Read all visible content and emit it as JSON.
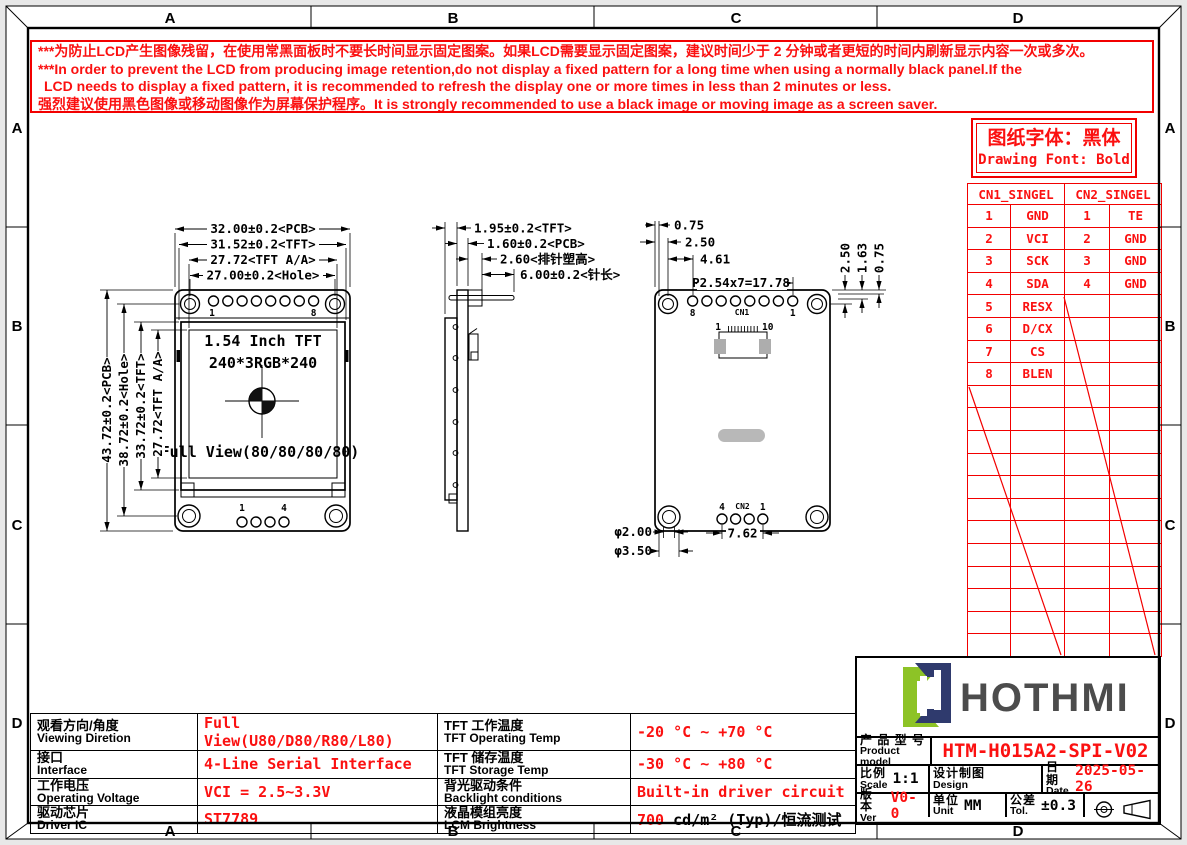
{
  "page": {
    "zones_h": [
      "A",
      "B",
      "C",
      "D"
    ],
    "zones_v": [
      "A",
      "B",
      "C",
      "D"
    ]
  },
  "colors": {
    "line_red": "#f20000",
    "text_red": "#fb1010",
    "logo_green": "#8dc326",
    "logo_navy": "#2f3a6d",
    "brand_gray": "#4c4c4c",
    "pad_gray": "#adadad"
  },
  "warning": {
    "lines": [
      "***为防止LCD产生图像残留，在使用常黑面板时不要长时间显示固定图案。如果LCD需要显示固定图案，建议时间少于 2 分钟或者更短的时间内刷新显示内容一次或多次。",
      "***In order to prevent the LCD from producing image retention,do not display a fixed pattern for a long time when using a normally black panel.If the",
      "LCD needs to display a fixed pattern,  it is recommended to refresh the display one or more times in less than 2 minutes or less.",
      "强烈建议使用黑色图像或移动图像作为屏幕保护程序。It is strongly recommended to use a black image or moving image as a screen saver."
    ]
  },
  "font_note": {
    "cn": "图纸字体：黑体",
    "en": "Drawing Font: Bold"
  },
  "pin_table": {
    "headers": [
      "CN1_SINGEL",
      "CN2_SINGEL"
    ],
    "cn1": [
      [
        "1",
        "GND"
      ],
      [
        "2",
        "VCI"
      ],
      [
        "3",
        "SCK"
      ],
      [
        "4",
        "SDA"
      ],
      [
        "5",
        "RESX"
      ],
      [
        "6",
        "D/CX"
      ],
      [
        "7",
        "CS"
      ],
      [
        "8",
        "BLEN"
      ]
    ],
    "cn2": [
      [
        "1",
        "TE"
      ],
      [
        "2",
        "GND"
      ],
      [
        "3",
        "GND"
      ],
      [
        "4",
        "GND"
      ]
    ]
  },
  "front_view": {
    "dims_top": [
      "32.00±0.2<PCB>",
      "31.52±0.2<TFT>",
      "27.72<TFT A/A>",
      "27.00±0.2<Hole>"
    ],
    "dims_left": [
      "43.72±0.2<PCB>",
      "38.72±0.2<Hole>",
      "33.72±0.2<TFT>",
      "27.72<TFT A/A>"
    ],
    "label_line1": "1.54 Inch TFT",
    "label_line2": "240*3RGB*240",
    "label_fullview": "Full View(80/80/80/80)",
    "top_pin_first": "1",
    "top_pin_last": "8",
    "bottom_pin_first": "1",
    "bottom_pin_last": "4"
  },
  "side_view": {
    "dim_tft": "1.95±0.2<TFT>",
    "dim_pcb": "1.60±0.2<PCB>",
    "dim_plastic": "2.60<排针塑高>",
    "dim_pin": "6.00±0.2<针长>"
  },
  "back_view": {
    "dim_1": "0.75",
    "dim_2": "2.50",
    "dim_3": "4.61",
    "dim_pitch": "P2.54x7=17.78",
    "dim_r1": "2.50",
    "dim_r2": "1.63",
    "dim_r3": "0.75",
    "label_cn1": "CN1",
    "pin8": "8",
    "pin1": "1",
    "fpc1": "1",
    "fpc10": "10",
    "label_cn2": "CN2",
    "cn2_pin4": "4",
    "cn2_pin1": "1",
    "dim_hole_inner": "φ2.00",
    "dim_hole_outer": "φ3.50",
    "dim_pitch2": "7.62"
  },
  "spec": {
    "rows_left": [
      {
        "cn": "观看方向/角度",
        "en": "Viewing Diretion",
        "value": "Full View(U80/D80/R80/L80)"
      },
      {
        "cn": "接口",
        "en": "Interface",
        "value": "4-Line Serial Interface"
      },
      {
        "cn": "工作电压",
        "en": "Operating Voltage",
        "value": "VCI = 2.5~3.3V"
      },
      {
        "cn": "驱动芯片",
        "en": "Driver IC",
        "value": "ST7789"
      }
    ],
    "rows_right": [
      {
        "cn": "TFT 工作温度",
        "en": "TFT Operating Temp",
        "value": "-20 °C ~ +70 °C"
      },
      {
        "cn": "TFT 储存温度",
        "en": "TFT Storage Temp",
        "value": "-30 °C ~ +80 °C"
      },
      {
        "cn": "背光驱动条件",
        "en": "Backlight conditions",
        "value": "Built-in driver circuit"
      },
      {
        "cn": "液晶模组亮度",
        "en": "LCM Brightness",
        "value_red": "700",
        "value_rest": " cd/m² (Typ)/恒流测试"
      }
    ]
  },
  "title_block": {
    "brand": "HOTHMI",
    "product_label_cn": "产 品 型 号",
    "product_label_en": "Product model",
    "product_value": "HTM-H015A2-SPI-V02",
    "scale_cn": "比例",
    "scale_en": "Scale",
    "scale_value": "1:1",
    "design_cn": "设计制图",
    "design_en": "Design",
    "date_cn": "日期",
    "date_en": "Date",
    "date_value": "2025-05-26",
    "ver_cn": "版本",
    "ver_en": "Ver",
    "ver_value": "V0-0",
    "unit_cn": "单位",
    "unit_en": "Unit",
    "unit_value": "MM",
    "tol_cn": "公差",
    "tol_en": "Tol.",
    "tol_value": "±0.3"
  }
}
